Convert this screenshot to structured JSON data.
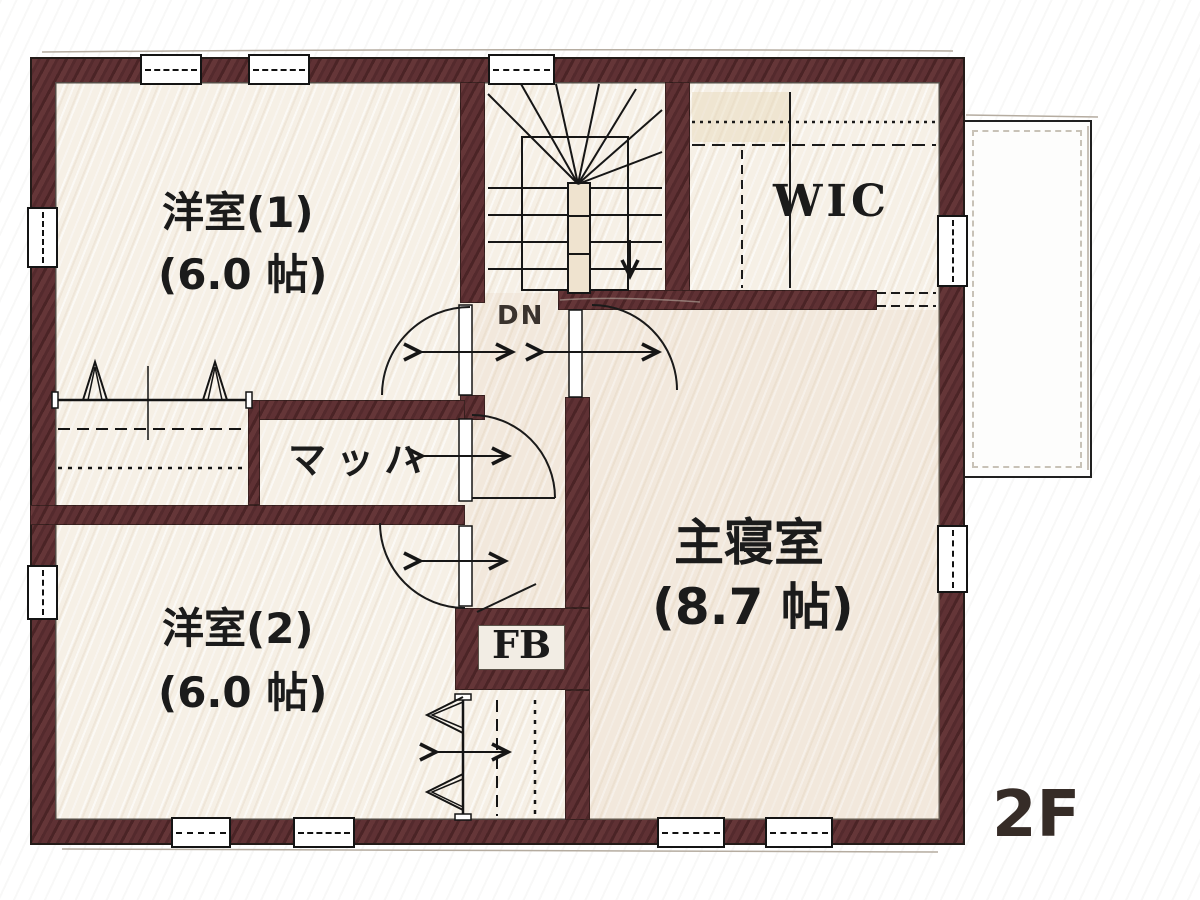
{
  "meta": {
    "floor_label": "2F",
    "plan_type": "floor-plan"
  },
  "rooms": {
    "western_room_1": {
      "name": "洋室(1)",
      "size": "(6.0 帖)"
    },
    "western_room_2": {
      "name": "洋室(2)",
      "size": "(6.0 帖)"
    },
    "master_bedroom": {
      "name": "主寝室",
      "size": "(8.7 帖)"
    },
    "wic": {
      "name": "WIC"
    },
    "closet_label": {
      "name": "マッハ"
    },
    "fb": {
      "name": "FB"
    },
    "stairs": {
      "down_label": "DN"
    }
  },
  "colors": {
    "wall": "#5c3133",
    "floor": "#f6f0e6",
    "line": "#141414",
    "sketch": "#b5aca0",
    "label": "#1b1b1b"
  },
  "symbols": {
    "window": "double-line window with dashed glazing",
    "hanger": "closet hanger-pipe symbol",
    "door_arc": "quarter-circle door swing",
    "stair_down": "winder staircase descending"
  }
}
